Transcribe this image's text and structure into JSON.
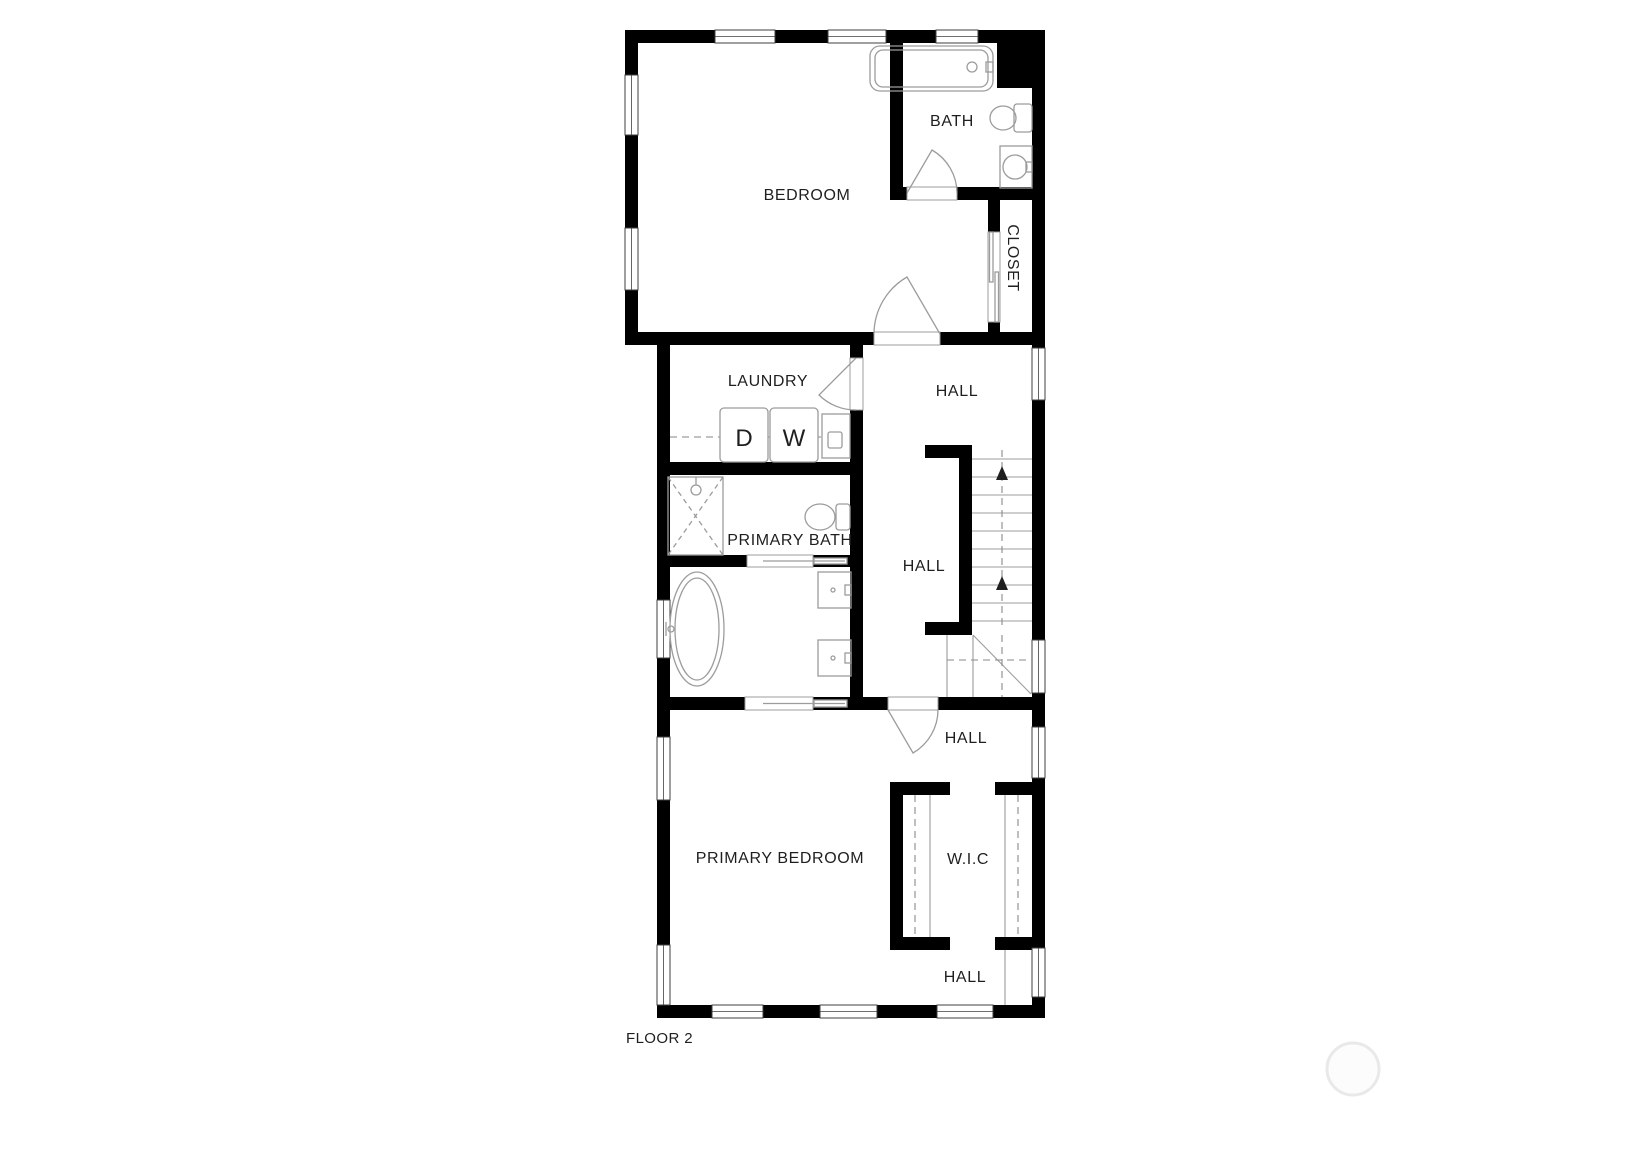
{
  "title": "FLOOR 2",
  "labels": {
    "bedroom": "BEDROOM",
    "bath": "BATH",
    "closet": "CLOSET",
    "laundry": "LAUNDRY",
    "hall_top": "HALL",
    "hall_stairs": "HALL",
    "hall_mid": "HALL",
    "hall_bottom": "HALL",
    "primary_bath": "PRIMARY BATH",
    "primary_bedroom": "PRIMARY BEDROOM",
    "wic": "W.I.C",
    "dryer": "D",
    "washer": "W"
  },
  "colors": {
    "wall": "#000000",
    "fixture_line": "#9c9c9c",
    "text": "#1f1f1f",
    "watermark_ring": "#e9e9e9"
  }
}
